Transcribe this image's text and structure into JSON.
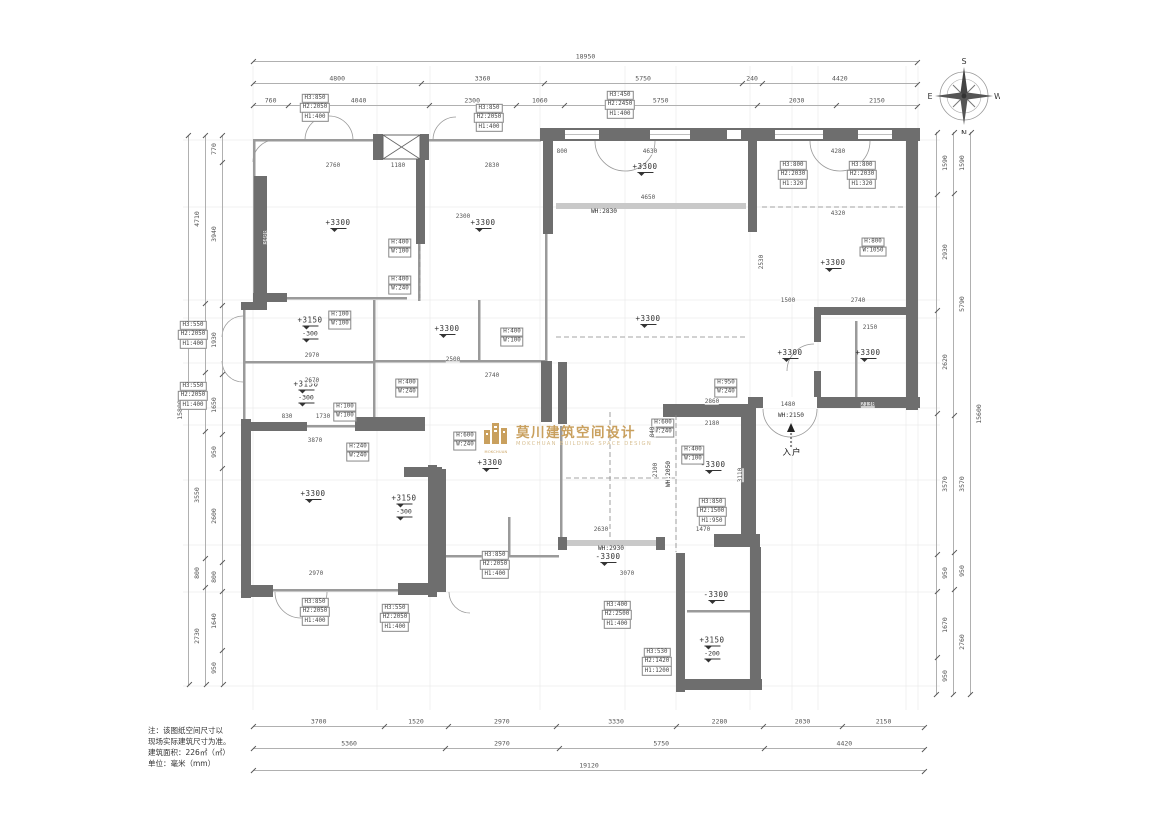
{
  "compass": {
    "top": "S",
    "bottom": "N",
    "left": "E",
    "right": "W"
  },
  "logo": {
    "cn": "莫川建筑空间设计",
    "en": "MOKCHUAN BUILDING SPACE DESIGN",
    "icon": "MOKCHUAN",
    "color": "#c9a05e"
  },
  "notes": {
    "text": "注：该图纸空间尺寸以\n现场实际建筑尺寸为准。\n建筑面积：226㎡（㎡）\n单位：毫米（mm）"
  },
  "dims": {
    "top": [
      [
        "18950"
      ],
      [
        "4800",
        "3360",
        "5750",
        "240",
        "4420"
      ],
      [
        "760",
        "4040",
        "2300",
        "1060",
        "5750",
        "2030",
        "2150"
      ]
    ],
    "bottom": [
      [
        "3700",
        "1520",
        "2970",
        "3330",
        "2280",
        "2030",
        "2150"
      ],
      [
        "5360",
        "2970",
        "5750",
        "4420"
      ],
      [
        "19120"
      ]
    ],
    "left": [
      [
        "15800"
      ],
      [
        "4710",
        "1930",
        "1650",
        "3550",
        "800",
        "2730"
      ],
      [
        "770",
        "3940",
        "1930",
        "1650",
        "950",
        "2600",
        "800",
        "1640",
        "950"
      ]
    ],
    "right": [
      [
        "1590",
        "2930",
        "2620",
        "3570",
        "950",
        "1670",
        "950"
      ],
      [
        "1590",
        "5790",
        "3570",
        "950",
        "2760"
      ],
      [
        "15600"
      ]
    ]
  },
  "plan": {
    "rooms": [
      {
        "label": "+3300",
        "x": 338,
        "y": 226
      },
      {
        "label": "+3300",
        "x": 483,
        "y": 226
      },
      {
        "label": "+3300",
        "x": 645,
        "y": 170
      },
      {
        "label": "+3300",
        "x": 648,
        "y": 322
      },
      {
        "label": "+3300",
        "x": 833,
        "y": 266
      },
      {
        "label": "+3300",
        "x": 790,
        "y": 356
      },
      {
        "label": "+3300",
        "x": 868,
        "y": 356
      },
      {
        "label": "+3150",
        "sub": "-300",
        "x": 310,
        "y": 330
      },
      {
        "label": "+3150",
        "sub": "-300",
        "x": 306,
        "y": 394
      },
      {
        "label": "+3300",
        "x": 447,
        "y": 332
      },
      {
        "label": "+3300",
        "x": 313,
        "y": 497
      },
      {
        "label": "+3150",
        "sub": "-300",
        "x": 404,
        "y": 508
      },
      {
        "label": "+3300",
        "x": 490,
        "y": 466
      },
      {
        "label": "-3300",
        "x": 608,
        "y": 560
      },
      {
        "label": "-3300",
        "x": 713,
        "y": 468
      },
      {
        "label": "-3300",
        "x": 716,
        "y": 598
      },
      {
        "label": "+3150",
        "sub": "-200",
        "x": 712,
        "y": 650
      }
    ],
    "boxes": [
      {
        "x": 315,
        "y": 108,
        "lines": [
          "H3:850",
          "H2:2050",
          "H1:400"
        ]
      },
      {
        "x": 489,
        "y": 118,
        "lines": [
          "H3:850",
          "H2:2050",
          "H1:400"
        ]
      },
      {
        "x": 620,
        "y": 105,
        "lines": [
          "H3:450",
          "H2:2450",
          "H1:400"
        ]
      },
      {
        "x": 793,
        "y": 175,
        "lines": [
          "H3:800",
          "H2:2030",
          "H1:320"
        ]
      },
      {
        "x": 862,
        "y": 175,
        "lines": [
          "H3:800",
          "H2:2030",
          "H1:320"
        ]
      },
      {
        "x": 873,
        "y": 247,
        "lines": [
          "H:800",
          "W:1050"
        ]
      },
      {
        "x": 400,
        "y": 248,
        "lines": [
          "H:400",
          "W:100"
        ]
      },
      {
        "x": 400,
        "y": 285,
        "lines": [
          "H:400",
          "W:240"
        ]
      },
      {
        "x": 340,
        "y": 320,
        "lines": [
          "H:100",
          "W:100"
        ]
      },
      {
        "x": 512,
        "y": 337,
        "lines": [
          "H:400",
          "W:100"
        ]
      },
      {
        "x": 407,
        "y": 388,
        "lines": [
          "H:400",
          "W:240"
        ]
      },
      {
        "x": 345,
        "y": 412,
        "lines": [
          "H:100",
          "W:100"
        ]
      },
      {
        "x": 358,
        "y": 452,
        "lines": [
          "H:240",
          "W:240"
        ]
      },
      {
        "x": 465,
        "y": 441,
        "lines": [
          "H:600",
          "W:240"
        ]
      },
      {
        "x": 663,
        "y": 428,
        "lines": [
          "H:600",
          "W:240"
        ]
      },
      {
        "x": 726,
        "y": 388,
        "lines": [
          "H:950",
          "W:240"
        ]
      },
      {
        "x": 693,
        "y": 455,
        "lines": [
          "H:400",
          "W:100"
        ]
      },
      {
        "x": 712,
        "y": 512,
        "lines": [
          "H3:850",
          "H2:1500",
          "H1:950"
        ]
      },
      {
        "x": 617,
        "y": 615,
        "lines": [
          "H3:400",
          "H2:2500",
          "H1:400"
        ]
      },
      {
        "x": 657,
        "y": 662,
        "lines": [
          "H3:530",
          "H2:1420",
          "H1:1200"
        ]
      },
      {
        "x": 315,
        "y": 612,
        "lines": [
          "H3:850",
          "H2:2050",
          "H1:400"
        ]
      },
      {
        "x": 395,
        "y": 618,
        "lines": [
          "H3:550",
          "H2:2050",
          "H1:400"
        ]
      },
      {
        "x": 495,
        "y": 565,
        "lines": [
          "H3:850",
          "H2:2050",
          "H1:400"
        ]
      },
      {
        "x": 193,
        "y": 335,
        "lines": [
          "H3:550",
          "H2:2050",
          "H1:400"
        ]
      },
      {
        "x": 193,
        "y": 396,
        "lines": [
          "H3:550",
          "H2:2050",
          "H1:400"
        ]
      }
    ],
    "wh_labels": [
      {
        "t": "WH:2830",
        "x": 604,
        "y": 212
      },
      {
        "t": "WH:2930",
        "x": 611,
        "y": 549
      },
      {
        "t": "WH:2150",
        "x": 791,
        "y": 416
      },
      {
        "t": "WH:2050",
        "x": 669,
        "y": 474,
        "r": 1
      }
    ],
    "inline_dims": [
      {
        "t": "2760",
        "x": 333,
        "y": 166
      },
      {
        "t": "1180",
        "x": 398,
        "y": 166
      },
      {
        "t": "2830",
        "x": 492,
        "y": 166
      },
      {
        "t": "800",
        "x": 562,
        "y": 152
      },
      {
        "t": "4630",
        "x": 650,
        "y": 152
      },
      {
        "t": "4280",
        "x": 838,
        "y": 152
      },
      {
        "t": "4650",
        "x": 648,
        "y": 198
      },
      {
        "t": "4320",
        "x": 838,
        "y": 214
      },
      {
        "t": "2300",
        "x": 463,
        "y": 217
      },
      {
        "t": "1500",
        "x": 788,
        "y": 301
      },
      {
        "t": "2740",
        "x": 858,
        "y": 301
      },
      {
        "t": "2150",
        "x": 870,
        "y": 328
      },
      {
        "t": "2130",
        "x": 868,
        "y": 405
      },
      {
        "t": "1480",
        "x": 788,
        "y": 405
      },
      {
        "t": "2970",
        "x": 312,
        "y": 356
      },
      {
        "t": "2670",
        "x": 312,
        "y": 381
      },
      {
        "t": "2500",
        "x": 453,
        "y": 360
      },
      {
        "t": "2740",
        "x": 492,
        "y": 376
      },
      {
        "t": "830",
        "x": 287,
        "y": 417
      },
      {
        "t": "1730",
        "x": 323,
        "y": 417
      },
      {
        "t": "3870",
        "x": 315,
        "y": 441
      },
      {
        "t": "2970",
        "x": 316,
        "y": 574
      },
      {
        "t": "2630",
        "x": 601,
        "y": 530
      },
      {
        "t": "3070",
        "x": 627,
        "y": 574
      },
      {
        "t": "1470",
        "x": 703,
        "y": 530
      },
      {
        "t": "2860",
        "x": 712,
        "y": 402
      },
      {
        "t": "2180",
        "x": 712,
        "y": 424
      },
      {
        "t": "2100",
        "x": 656,
        "y": 470,
        "r": 1
      },
      {
        "t": "3110",
        "x": 741,
        "y": 475,
        "r": 1
      },
      {
        "t": "840",
        "x": 653,
        "y": 432,
        "r": 1
      },
      {
        "t": "3400",
        "x": 266,
        "y": 237,
        "r": 1
      },
      {
        "t": "2530",
        "x": 762,
        "y": 262,
        "r": 1
      }
    ],
    "entry": {
      "label": "入户",
      "x": 792,
      "y": 452
    }
  },
  "colors": {
    "wall": "#6e6e6e",
    "thin_wall": "#9a9a9a",
    "accent": "#c9a05e",
    "dim_text": "#555555"
  }
}
